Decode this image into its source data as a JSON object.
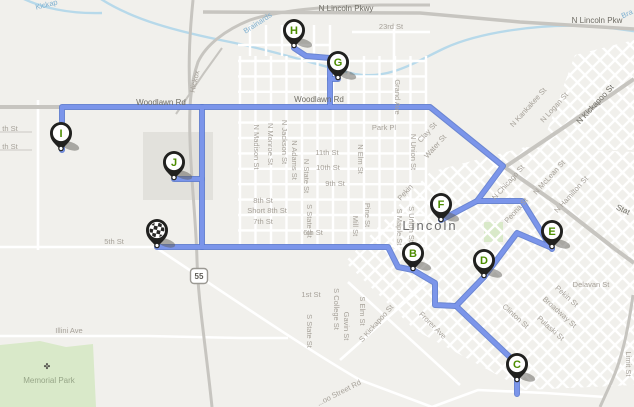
{
  "map": {
    "background": "#f1f0ec",
    "block_color": "#e2e1dc",
    "park_color": "#d9e9c9",
    "water_color": "#b7d9ea",
    "major_road_color": "#c7c5c0",
    "minor_road_color": "#ffffff",
    "route_color": "#7b95ea",
    "route_casing_color": "#5c7ace",
    "marker_outline_color": "#21211f",
    "marker_letter_color": "#4c8c00"
  },
  "city_label": {
    "text": "Lincoln",
    "x": 430,
    "y": 230
  },
  "highway_shield": {
    "text": "55",
    "x": 199,
    "y": 276
  },
  "park_label": {
    "text": "Memorial Park",
    "x": 49,
    "y": 383
  },
  "tree_icon": {
    "glyph": "✤",
    "x": 47,
    "y": 369
  },
  "markers": [
    {
      "id": "start",
      "kind": "checkered",
      "letter": "",
      "x": 157,
      "y": 247
    },
    {
      "id": "B",
      "kind": "stop",
      "letter": "B",
      "x": 413,
      "y": 270
    },
    {
      "id": "C",
      "kind": "stop",
      "letter": "C",
      "x": 517,
      "y": 381
    },
    {
      "id": "D",
      "kind": "stop",
      "letter": "D",
      "x": 484,
      "y": 277
    },
    {
      "id": "E",
      "kind": "stop",
      "letter": "E",
      "x": 552,
      "y": 248
    },
    {
      "id": "F",
      "kind": "stop",
      "letter": "F",
      "x": 441,
      "y": 221
    },
    {
      "id": "G",
      "kind": "stop",
      "letter": "G",
      "x": 338,
      "y": 79
    },
    {
      "id": "H",
      "kind": "stop",
      "letter": "H",
      "x": 294,
      "y": 47
    },
    {
      "id": "I",
      "kind": "stop",
      "letter": "I",
      "x": 61,
      "y": 150
    },
    {
      "id": "J",
      "kind": "stop",
      "letter": "J",
      "x": 174,
      "y": 179
    }
  ],
  "route_paths": [
    [
      [
        62,
        150
      ],
      [
        62,
        107
      ],
      [
        430,
        107
      ],
      [
        503,
        166
      ],
      [
        477,
        201
      ],
      [
        441,
        220
      ]
    ],
    [
      [
        330,
        107
      ],
      [
        330,
        58
      ],
      [
        306,
        56
      ],
      [
        300,
        52
      ],
      [
        294,
        48
      ]
    ],
    [
      [
        330,
        79
      ],
      [
        338,
        79
      ]
    ],
    [
      [
        202,
        107
      ],
      [
        202,
        247
      ]
    ],
    [
      [
        202,
        179
      ],
      [
        174,
        179
      ]
    ],
    [
      [
        157,
        247
      ],
      [
        388,
        247
      ],
      [
        398,
        267
      ],
      [
        413,
        270
      ]
    ],
    [
      [
        413,
        270
      ],
      [
        435,
        283
      ],
      [
        435,
        305
      ],
      [
        456,
        306
      ],
      [
        513,
        360
      ],
      [
        517,
        367
      ],
      [
        517,
        394
      ]
    ],
    [
      [
        484,
        277
      ],
      [
        456,
        306
      ]
    ],
    [
      [
        484,
        277
      ],
      [
        517,
        233
      ],
      [
        552,
        248
      ]
    ],
    [
      [
        477,
        201
      ],
      [
        522,
        201
      ],
      [
        552,
        249
      ]
    ]
  ],
  "road_labels": [
    {
      "t": "Kickap",
      "x": 47,
      "y": 7,
      "rot": -14,
      "cls": "water"
    },
    {
      "t": "Brainards",
      "x": 259,
      "y": 25,
      "rot": -33,
      "cls": "water"
    },
    {
      "t": "Bra",
      "x": 628,
      "y": 16,
      "rot": -25,
      "cls": "water"
    },
    {
      "t": "N Lincoln Pkwy",
      "x": 346,
      "y": 11,
      "rot": 0,
      "cls": "major"
    },
    {
      "t": "N Lincoln Pkw",
      "x": 597,
      "y": 23,
      "rot": 0,
      "cls": "major"
    },
    {
      "t": "Woodlawn Rd",
      "x": 161,
      "y": 105,
      "rot": 0,
      "cls": "major"
    },
    {
      "t": "Woodlawn Rd",
      "x": 319,
      "y": 102,
      "rot": 0,
      "cls": "major"
    },
    {
      "t": "N Kickapoo St",
      "x": 597,
      "y": 106,
      "rot": -47,
      "cls": "major"
    },
    {
      "t": "Stat",
      "x": 622,
      "y": 212,
      "rot": 25,
      "cls": "major"
    },
    {
      "t": "23rd St",
      "x": 391,
      "y": 29,
      "rot": 0,
      "cls": "minor"
    },
    {
      "t": "Hickox",
      "x": 197,
      "y": 82,
      "rot": -77,
      "cls": "minor"
    },
    {
      "t": "Grand Ave",
      "x": 395,
      "y": 97,
      "rot": 90,
      "cls": "minor"
    },
    {
      "t": "Park Pl",
      "x": 384,
      "y": 130,
      "rot": 0,
      "cls": "minor"
    },
    {
      "t": "11th St",
      "x": 327,
      "y": 155,
      "rot": 0,
      "cls": "minor"
    },
    {
      "t": "10th St",
      "x": 328,
      "y": 170,
      "rot": 0,
      "cls": "minor"
    },
    {
      "t": "9th St",
      "x": 335,
      "y": 186,
      "rot": 0,
      "cls": "minor"
    },
    {
      "t": "8th St",
      "x": 263,
      "y": 203,
      "rot": 0,
      "cls": "minor"
    },
    {
      "t": "Short 8th St",
      "x": 267,
      "y": 213,
      "rot": 0,
      "cls": "minor"
    },
    {
      "t": "7th St",
      "x": 263,
      "y": 224,
      "rot": 0,
      "cls": "minor"
    },
    {
      "t": "6th St",
      "x": 313,
      "y": 235,
      "rot": 0,
      "cls": "minor"
    },
    {
      "t": "5th St",
      "x": 114,
      "y": 244,
      "rot": 0,
      "cls": "minor"
    },
    {
      "t": "1st St",
      "x": 311,
      "y": 297,
      "rot": 0,
      "cls": "minor"
    },
    {
      "t": "Delavan St",
      "x": 591,
      "y": 287,
      "rot": 0,
      "cls": "minor"
    },
    {
      "t": "Illini Ave",
      "x": 69,
      "y": 333,
      "rot": 0,
      "cls": "minor"
    },
    {
      "t": "th St",
      "x": 10,
      "y": 131,
      "rot": 0,
      "cls": "minor"
    },
    {
      "t": "th St",
      "x": 10,
      "y": 149,
      "rot": 0,
      "cls": "minor"
    },
    {
      "t": "N Madison St",
      "x": 254,
      "y": 147,
      "rot": 90,
      "cls": "minor"
    },
    {
      "t": "N Monroe St",
      "x": 268,
      "y": 144,
      "rot": 90,
      "cls": "minor"
    },
    {
      "t": "N Jackson St",
      "x": 282,
      "y": 142,
      "rot": 90,
      "cls": "minor"
    },
    {
      "t": "N Adams St",
      "x": 292,
      "y": 160,
      "rot": 90,
      "cls": "minor"
    },
    {
      "t": "N State St",
      "x": 304,
      "y": 176,
      "rot": 90,
      "cls": "minor"
    },
    {
      "t": "N Elm St",
      "x": 358,
      "y": 159,
      "rot": 90,
      "cls": "minor"
    },
    {
      "t": "N Union St",
      "x": 411,
      "y": 152,
      "rot": 90,
      "cls": "minor"
    },
    {
      "t": "S Union St",
      "x": 409,
      "y": 224,
      "rot": 90,
      "cls": "minor"
    },
    {
      "t": "S Maple St",
      "x": 397,
      "y": 227,
      "rot": 90,
      "cls": "minor"
    },
    {
      "t": "Pine St",
      "x": 365,
      "y": 215,
      "rot": 90,
      "cls": "minor"
    },
    {
      "t": "Mill St",
      "x": 353,
      "y": 226,
      "rot": 90,
      "cls": "minor"
    },
    {
      "t": "S State St",
      "x": 307,
      "y": 221,
      "rot": 90,
      "cls": "minor"
    },
    {
      "t": "S College St",
      "x": 334,
      "y": 309,
      "rot": 90,
      "cls": "minor"
    },
    {
      "t": "Gavin St",
      "x": 344,
      "y": 326,
      "rot": 90,
      "cls": "minor"
    },
    {
      "t": "S State St",
      "x": 307,
      "y": 331,
      "rot": 90,
      "cls": "minor"
    },
    {
      "t": "S Elm St",
      "x": 360,
      "y": 311,
      "rot": 90,
      "cls": "minor"
    },
    {
      "t": "Limit St",
      "x": 626,
      "y": 364,
      "rot": 90,
      "cls": "minor"
    },
    {
      "t": "Clay St",
      "x": 429,
      "y": 134,
      "rot": -48,
      "cls": "minor"
    },
    {
      "t": "Water St",
      "x": 437,
      "y": 148,
      "rot": -48,
      "cls": "minor"
    },
    {
      "t": "Pekin",
      "x": 407,
      "y": 194,
      "rot": -48,
      "cls": "minor"
    },
    {
      "t": "N Chicago St",
      "x": 510,
      "y": 184,
      "rot": -48,
      "cls": "minor"
    },
    {
      "t": "Peoria St",
      "x": 518,
      "y": 212,
      "rot": -48,
      "cls": "minor"
    },
    {
      "t": "N McLean St",
      "x": 551,
      "y": 179,
      "rot": -48,
      "cls": "minor"
    },
    {
      "t": "N Hamilton St",
      "x": 573,
      "y": 196,
      "rot": -48,
      "cls": "minor"
    },
    {
      "t": "N Kankakee St",
      "x": 530,
      "y": 109,
      "rot": -48,
      "cls": "minor"
    },
    {
      "t": "N Logan St",
      "x": 556,
      "y": 109,
      "rot": -48,
      "cls": "minor"
    },
    {
      "t": "S Kickapoo St",
      "x": 378,
      "y": 325,
      "rot": -48,
      "cls": "minor"
    },
    {
      "t": "Clinton St",
      "x": 514,
      "y": 318,
      "rot": 42,
      "cls": "minor"
    },
    {
      "t": "Broadway St",
      "x": 558,
      "y": 314,
      "rot": 42,
      "cls": "minor"
    },
    {
      "t": "Pulaski St",
      "x": 549,
      "y": 330,
      "rot": 42,
      "cls": "minor"
    },
    {
      "t": "Pekin St",
      "x": 565,
      "y": 298,
      "rot": 42,
      "cls": "minor"
    },
    {
      "t": "Frorer Ave",
      "x": 431,
      "y": 327,
      "rot": 45,
      "cls": "minor"
    },
    {
      "t": "...oo Street Rd",
      "x": 340,
      "y": 395,
      "rot": -27,
      "cls": "minor"
    }
  ]
}
